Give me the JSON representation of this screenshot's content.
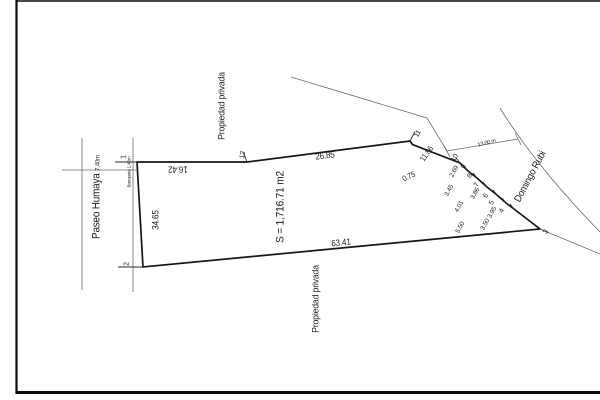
{
  "plot": {
    "area_label": "S = 1,716.71 m2",
    "west_street": {
      "name": "Paseo Humaya",
      "width": "7.40m"
    },
    "sidewalk_label": "Banqueta 1.40m",
    "east_street": {
      "name": "Domingo Rubi",
      "width_label": "13.00 m"
    },
    "north_neighbor": "Propiedad privada",
    "south_neighbor": "Propiedad privada",
    "dimensions": {
      "north_a": "16.42",
      "north_b": "26.85",
      "west": "34.65",
      "south": "63.41",
      "northeast": "11.86",
      "jog": "0.75",
      "east_1": "2.69",
      "east_2": "3.45",
      "east_3": "3.86",
      "east_4": "4.01",
      "east_5": "3.95",
      "east_6": "3.50",
      "east_7": "5.50"
    },
    "vertices": {
      "v1": "1",
      "v2": "2",
      "v3": "3",
      "v4": "4",
      "v5": "5",
      "v6": "6",
      "v7": "7",
      "v8": "8",
      "v9": "9",
      "v10": "10",
      "v11": "11",
      "v12": "12"
    }
  }
}
